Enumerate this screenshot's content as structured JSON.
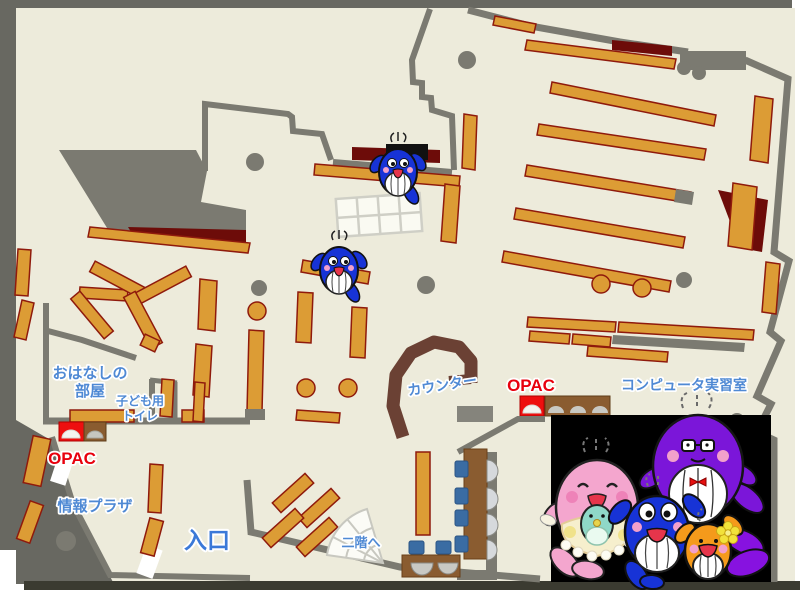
{
  "labels": {
    "storytelling_room_line1": "おはなしの",
    "storytelling_room_line2": "部屋",
    "kids_toilet_line1": "子ども用",
    "kids_toilet_line2": "トイレ",
    "opac_left": "OPAC",
    "info_plaza": "情報プラザ",
    "entrance": "入口",
    "counter": "カウンター",
    "opac_right": "OPAC",
    "computer_room": "コンピュータ実習室",
    "stairs_to_2f": "二階へ"
  },
  "colors": {
    "floor": "#edebdb",
    "wall": "#7b7a71",
    "outer_frame": "#686861",
    "bookshelf": "#dc9c35",
    "bookshelf_border": "#8f1a0c",
    "accent_dark_red": "#6d0c09",
    "counter_brown": "#6b4134",
    "desk_brown": "#8a5c30",
    "seat_blue": "#3a6ca3",
    "label_blue": "#4f89d4",
    "opac_red": "#e8000d",
    "mascot_panel": "#000000"
  },
  "icons": {
    "map_whales": "blue-whale-mascot-icon",
    "mascot_pink": "pink-whale-mascot-icon",
    "mascot_purple": "purple-whale-mascot-icon",
    "mascot_blue": "blue-whale-mascot-icon",
    "mascot_orange": "orange-whale-mascot-icon",
    "stairs": "stairs-fan-icon",
    "opac_terminals": "opac-terminal-icon"
  }
}
